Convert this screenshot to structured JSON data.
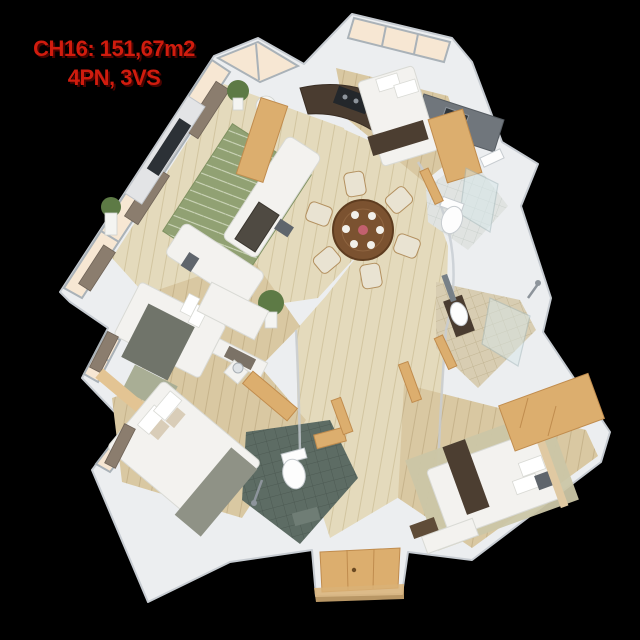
{
  "title": {
    "line1": "CH16: 151,67m2",
    "line2": "4PN, 3VS"
  },
  "apartment": {
    "unit": "CH16",
    "area": "151,67m2",
    "bedrooms": "4PN",
    "bathrooms": "3VS"
  },
  "colors": {
    "bg": "#000000",
    "accent": "#d01c0e",
    "accent_shadow": "#4a0300",
    "wall": "#eceef0",
    "wall_edge": "#c7ccd2",
    "wood_light": "#e4dabc",
    "plank_light": "#d2c5a0",
    "wood_mid": "#d9c8a2",
    "plank_mid": "#c6b38b",
    "rug_green": "#91a173",
    "rug_lattice": "#e7ecd8",
    "rug_pale": "#cbc6a6",
    "oak": "#dcae6e",
    "oak_dark": "#c08c4e",
    "counter": "#4a3c30",
    "steel": "#8d949b",
    "curtain": "#8b7d6e",
    "plant": "#5d7a45",
    "pot_white": "#f4f4f1",
    "glass": "#f7e7d3",
    "frame": "#aab2b8",
    "tile_dark": "#5d6c64",
    "tile_dark_line": "#4d5a53",
    "tile_beige": "#d8cdb2",
    "tile_beige_line": "#c2b593",
    "tile_gray": "#e0e3e1",
    "tile_gray_line": "#cbd1cd",
    "fabric_white": "#f3f2ef",
    "fabric_stroke": "#d9dad5",
    "pillow_gray": "#5f656c",
    "runner_brown": "#4c3e31",
    "runner_gray": "#8f9286",
    "duvet_gray": "#70746a",
    "table_wood": "#7b5230",
    "table_wood_dark": "#5e3c1f",
    "chair_cream": "#e9e3d2",
    "chair_edge": "#b3905f",
    "marble": "#e3e4e6",
    "tv_dark": "#2c3136",
    "console_brown": "#46382c",
    "glasswall": "#d7e8ea",
    "glasswall_edge": "#a3b8bb"
  }
}
